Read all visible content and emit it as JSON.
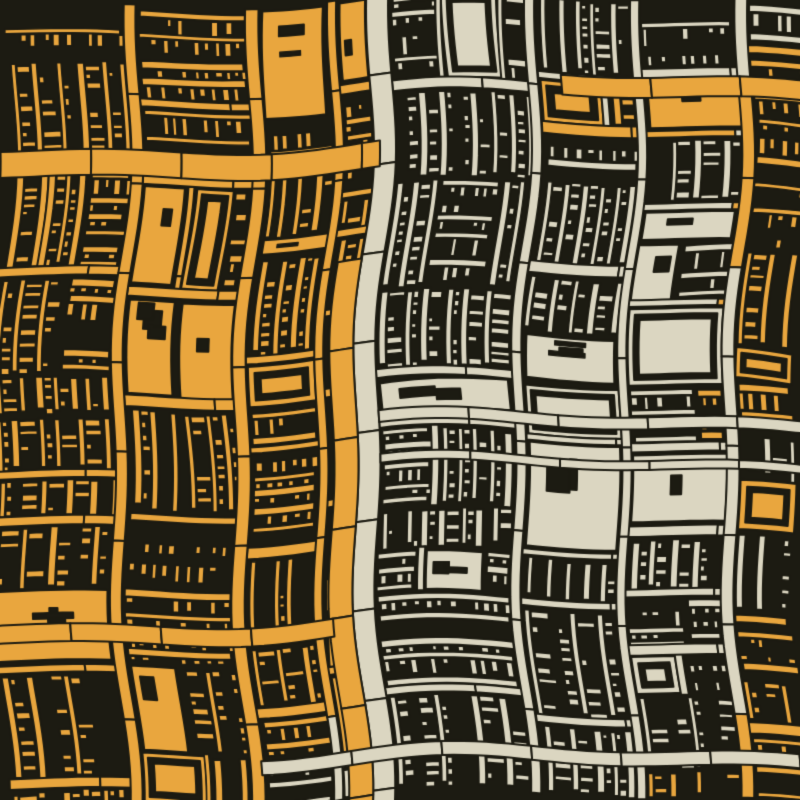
{
  "artwork": {
    "kind": "generative-abstract-pattern",
    "description": "Warped rectangular city-grid / bookshelf texture, orange and cream bars on near-black",
    "alt_text": "Dense abstract pattern of warped rectangles and bars; left half amber orange, right half cream, dark background"
  },
  "canvas": {
    "width": 800,
    "height": 800
  },
  "palette": {
    "background": "#1c1b12",
    "orange": "#e9a63e",
    "cream": "#dbd6c1"
  },
  "seed": 47,
  "warp": {
    "dx": [
      {
        "amp": 9,
        "freq": 0.0075,
        "phase": 1.1
      },
      {
        "amp": 5,
        "freq": 0.021,
        "phase": 4.2
      },
      {
        "amp": 2.5,
        "freq": 0.003,
        "phase": 0.5,
        "axis": "x"
      }
    ],
    "dy": [
      {
        "amp": 8,
        "freq": 0.0082,
        "phase": 0.6
      },
      {
        "amp": 5,
        "freq": 0.019,
        "phase": 2.9
      },
      {
        "amp": 2.5,
        "freq": 0.0035,
        "phase": 1.7,
        "axis": "y"
      }
    ]
  },
  "regions": {
    "leftBoundary": {
      "base": 356,
      "amp": 10,
      "freq": 0.009,
      "phase": 1.2,
      "jitter": 16
    },
    "topRight": {
      "x": 528,
      "y0": 52,
      "y1": 138,
      "orangeProb": 0.55
    },
    "rightEdge": {
      "base": 742,
      "bulgeAmp": 48,
      "bulgeCenter": 340,
      "bulgeWidth": 110,
      "jitter": 26,
      "y0": 35,
      "y1": 545,
      "orangeProb": 0.85
    },
    "bottomRight": {
      "y0": 595,
      "slope": 0.5,
      "jitter": 32,
      "orangeProb": 0.85
    },
    "bottomCreamStrip": {
      "y": 748,
      "x": 252
    }
  },
  "layout": {
    "rootPanels": [
      [
        0,
        0,
        358,
        800
      ],
      [
        384,
        0,
        416,
        800
      ]
    ],
    "depth0": {
      "segMin": 64,
      "segMax": 150,
      "roadProb": 0.7,
      "roadMin": 8,
      "roadMax": 16
    },
    "depth1": {
      "segMin": 36,
      "segMax": 112,
      "roadProb": 0.45,
      "roadMin": 6,
      "roadMax": 12
    },
    "depth2": {
      "segMin": 30,
      "segMax": 70,
      "roadProb": 0.25,
      "roadMin": 4,
      "roadMax": 8,
      "splitProb": 0.55,
      "minSize": 64
    },
    "texture": {
      "shelfProb": 0.85,
      "bookProb": 0.8,
      "barMin": 4,
      "barMax": 8,
      "gapMin": 6,
      "gapMax": 20,
      "bookWMin": 3.5,
      "bookWMax": 7,
      "fullBookProb": 0.55,
      "nestedProb": 0.12,
      "solidProb": 0.1,
      "alongAxisProb": 0.6,
      "rotateProb": 0.2,
      "rotMax": 5
    },
    "roadChunk": 90
  },
  "roads": [
    {
      "x": 360,
      "y": -12,
      "w": 22,
      "h": 824,
      "color": "cream"
    },
    {
      "x": 336,
      "y": 262,
      "w": 24,
      "h": 550,
      "color": "orange"
    },
    {
      "x": -12,
      "y": 144,
      "w": 378,
      "h": 26,
      "color": "orange"
    },
    {
      "x": 552,
      "y": 76,
      "w": 260,
      "h": 20,
      "color": "orange"
    },
    {
      "x": -12,
      "y": 622,
      "w": 352,
      "h": 18,
      "color": "orange"
    },
    {
      "x": 382,
      "y": 418,
      "w": 430,
      "h": 12,
      "color": "cream"
    },
    {
      "x": 382,
      "y": 462,
      "w": 430,
      "h": 9,
      "color": "cream"
    },
    {
      "x": 250,
      "y": 755,
      "w": 562,
      "h": 14,
      "color": "cream"
    }
  ]
}
